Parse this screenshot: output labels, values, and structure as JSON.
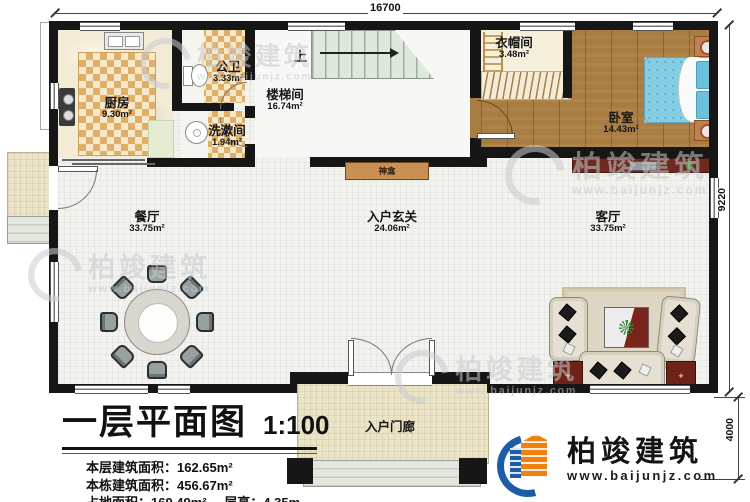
{
  "plan": {
    "dims": {
      "top": "16700",
      "right": "9220",
      "porch": "4000"
    },
    "rooms": {
      "kitchen": {
        "name": "厨房",
        "area": "9.30m²"
      },
      "bath": {
        "name": "公卫",
        "area": "3.33m²"
      },
      "laundry": {
        "name": "洗漱间",
        "area": "1.94m²"
      },
      "stairhall": {
        "name": "楼梯间",
        "area": "16.74m²"
      },
      "cloak": {
        "name": "衣帽间",
        "area": "3.48m²"
      },
      "bedroom": {
        "name": "卧室",
        "area": "14.43m²"
      },
      "dining": {
        "name": "餐厅",
        "area": "33.75m²"
      },
      "foyer": {
        "name": "入户玄关",
        "area": "24.06m²"
      },
      "living": {
        "name": "客厅",
        "area": "33.75m²"
      },
      "porch": {
        "name": "入户门廊"
      },
      "shrine": {
        "name": "神龛"
      }
    },
    "stairs_up": "上"
  },
  "title_block": {
    "title": "一层平面图",
    "scale": "1:100",
    "line1": "本层建筑面积：162.65m²",
    "line2": "本栋建筑面积：456.67m²",
    "line3a": "占地面积：169.49m²",
    "line3b": "层高：4.35m"
  },
  "brand": {
    "name": "柏竣建筑",
    "site": "www.baijunjz.com"
  },
  "watermark": {
    "name": "柏竣建筑",
    "site": "www.baijunjz.com"
  },
  "colors": {
    "wall": "#161616",
    "wood": "#a97c42",
    "checker": "#e0af67",
    "bed_blue": "#85cde2",
    "accent_red": "#6e2318",
    "brand_blue": "#1c5ca8",
    "brand_orange": "#f08010"
  }
}
